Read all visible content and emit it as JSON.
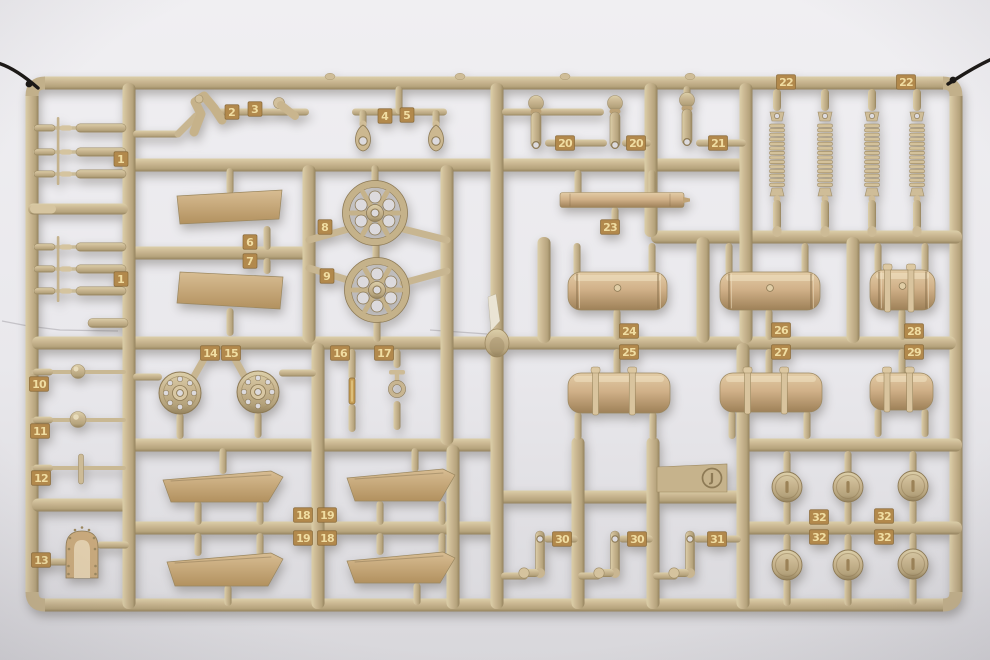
{
  "photo": {
    "subject": "tan plastic model-kit sprue (parts tree) photographed on a light gray background, hung on black wires",
    "sprue_letter": "J"
  },
  "sprue": {
    "letter": "J",
    "colors": {
      "runner_light": "#dccfa9",
      "runner_mid": "#c9b691",
      "runner_dark": "#94825d",
      "edge": "#8d7a55",
      "tag_bg": "#b2894c",
      "tag_text": "#f0dda2",
      "hole": "#dcdadd",
      "wire": "#1b1815",
      "bg_top": "#f0eff2",
      "bg_bottom": "#d8d7db"
    },
    "frame": {
      "top": 83,
      "bottom": 605,
      "left": 32,
      "right": 956,
      "thickness": 13
    },
    "runners_h": [
      [
        165,
        129,
        746
      ],
      [
        253,
        129,
        309
      ],
      [
        237,
        651,
        962
      ],
      [
        343,
        32,
        956
      ],
      [
        445,
        129,
        497
      ],
      [
        445,
        743,
        962
      ],
      [
        497,
        497,
        743
      ],
      [
        505,
        32,
        129
      ],
      [
        528,
        129,
        497
      ],
      [
        528,
        743,
        962
      ]
    ],
    "runners_v": [
      [
        129,
        83,
        609
      ],
      [
        309,
        165,
        343
      ],
      [
        318,
        343,
        609
      ],
      [
        447,
        165,
        445
      ],
      [
        453,
        445,
        609
      ],
      [
        497,
        83,
        609
      ],
      [
        544,
        237,
        343
      ],
      [
        651,
        83,
        237
      ],
      [
        746,
        83,
        343
      ],
      [
        703,
        237,
        343
      ],
      [
        853,
        237,
        343
      ],
      [
        743,
        343,
        609
      ],
      [
        578,
        437,
        609
      ],
      [
        653,
        437,
        609
      ]
    ],
    "rods_h": [
      [
        133,
        180,
        134
      ],
      [
        216,
        309,
        112
      ],
      [
        352,
        447,
        112
      ],
      [
        502,
        604,
        112
      ],
      [
        545,
        607,
        143
      ],
      [
        622,
        651,
        143
      ],
      [
        696,
        746,
        143
      ],
      [
        133,
        162,
        377
      ],
      [
        279,
        316,
        373
      ],
      [
        97,
        129,
        545
      ],
      [
        32,
        68,
        562
      ],
      [
        501,
        528,
        576
      ],
      [
        578,
        601,
        576
      ],
      [
        653,
        678,
        576
      ],
      [
        544,
        578,
        539
      ],
      [
        619,
        653,
        539
      ],
      [
        694,
        741,
        539
      ]
    ],
    "arms": [
      [
        309,
        240,
        352,
        228
      ],
      [
        399,
        228,
        447,
        240
      ],
      [
        309,
        268,
        351,
        281
      ],
      [
        403,
        283,
        447,
        271
      ],
      [
        192,
        380,
        208,
        352
      ],
      [
        246,
        379,
        231,
        352
      ],
      [
        178,
        134,
        196,
        116
      ]
    ],
    "stubs_v": [
      [
        399,
        86,
        112
      ],
      [
        363,
        110,
        126
      ],
      [
        436,
        110,
        126
      ],
      [
        230,
        168,
        192
      ],
      [
        267,
        226,
        248
      ],
      [
        267,
        258,
        272
      ],
      [
        230,
        308,
        334
      ],
      [
        375,
        165,
        186
      ],
      [
        376,
        240,
        263
      ],
      [
        377,
        317,
        340
      ],
      [
        687,
        86,
        97
      ],
      [
        578,
        170,
        194
      ],
      [
        652,
        170,
        194
      ],
      [
        615,
        207,
        221
      ],
      [
        577,
        243,
        273
      ],
      [
        652,
        243,
        273
      ],
      [
        617,
        309,
        338
      ],
      [
        617,
        349,
        374
      ],
      [
        578,
        412,
        438
      ],
      [
        653,
        412,
        438
      ],
      [
        729,
        243,
        273
      ],
      [
        805,
        243,
        273
      ],
      [
        769,
        309,
        338
      ],
      [
        769,
        349,
        374
      ],
      [
        732,
        411,
        437
      ],
      [
        807,
        411,
        437
      ],
      [
        878,
        243,
        271
      ],
      [
        925,
        243,
        271
      ],
      [
        902,
        309,
        338
      ],
      [
        902,
        349,
        374
      ],
      [
        878,
        409,
        435
      ],
      [
        925,
        409,
        435
      ],
      [
        180,
        413,
        437
      ],
      [
        258,
        412,
        436
      ],
      [
        352,
        349,
        378
      ],
      [
        352,
        404,
        430
      ],
      [
        397,
        349,
        366
      ],
      [
        397,
        401,
        428
      ],
      [
        223,
        448,
        472
      ],
      [
        415,
        448,
        470
      ],
      [
        198,
        501,
        523
      ],
      [
        260,
        501,
        523
      ],
      [
        380,
        501,
        523
      ],
      [
        442,
        501,
        523
      ],
      [
        198,
        533,
        554
      ],
      [
        260,
        533,
        554
      ],
      [
        380,
        533,
        553
      ],
      [
        442,
        533,
        553
      ],
      [
        228,
        585,
        604
      ],
      [
        417,
        583,
        603
      ],
      [
        787,
        451,
        474
      ],
      [
        848,
        451,
        474
      ],
      [
        913,
        451,
        473
      ],
      [
        787,
        500,
        523
      ],
      [
        848,
        500,
        523
      ],
      [
        913,
        499,
        522
      ],
      [
        787,
        534,
        552
      ],
      [
        848,
        534,
        552
      ],
      [
        913,
        533,
        551
      ],
      [
        787,
        578,
        604
      ],
      [
        848,
        578,
        604
      ],
      [
        913,
        577,
        603
      ]
    ],
    "bumps": [
      330,
      460,
      565,
      690
    ],
    "tags": [
      [
        "1",
        121,
        159
      ],
      [
        "1",
        121,
        279
      ],
      [
        "2",
        232,
        112
      ],
      [
        "3",
        255,
        109
      ],
      [
        "4",
        385,
        116
      ],
      [
        "5",
        407,
        115
      ],
      [
        "6",
        250,
        242
      ],
      [
        "7",
        250,
        261
      ],
      [
        "8",
        325,
        227
      ],
      [
        "9",
        327,
        276
      ],
      [
        "10",
        39,
        384
      ],
      [
        "11",
        40,
        431
      ],
      [
        "12",
        41,
        478
      ],
      [
        "13",
        41,
        560
      ],
      [
        "14",
        210,
        353
      ],
      [
        "15",
        231,
        353
      ],
      [
        "16",
        340,
        353
      ],
      [
        "17",
        384,
        353
      ],
      [
        "18",
        303,
        515
      ],
      [
        "19",
        327,
        515
      ],
      [
        "19",
        303,
        538
      ],
      [
        "18",
        327,
        538
      ],
      [
        "20",
        565,
        143
      ],
      [
        "20",
        636,
        143
      ],
      [
        "21",
        718,
        143
      ],
      [
        "22",
        786,
        82
      ],
      [
        "22",
        906,
        82
      ],
      [
        "23",
        610,
        227
      ],
      [
        "24",
        629,
        331
      ],
      [
        "25",
        629,
        352
      ],
      [
        "26",
        781,
        330
      ],
      [
        "27",
        781,
        352
      ],
      [
        "28",
        914,
        331
      ],
      [
        "29",
        914,
        352
      ],
      [
        "30",
        562,
        539
      ],
      [
        "30",
        637,
        539
      ],
      [
        "31",
        717,
        539
      ],
      [
        "32",
        819,
        517
      ],
      [
        "32",
        884,
        516
      ],
      [
        "32",
        819,
        537
      ],
      [
        "32",
        884,
        537
      ]
    ],
    "parts": [
      {
        "type": "rodgroup",
        "name": "part-1-torsion-bars-upper",
        "rows": [
          128,
          152,
          174
        ]
      },
      {
        "type": "rodgroup",
        "name": "part-1-torsion-bars-lower",
        "rows": [
          247,
          269,
          291
        ]
      },
      {
        "type": "thickrod",
        "name": "left-rung-rod",
        "x1": 28,
        "x2": 128,
        "y": 209
      },
      {
        "type": "bulletrod",
        "name": "left-small-rod",
        "x1": 88,
        "x2": 128,
        "y": 323
      },
      {
        "type": "bracket",
        "name": "part-2-bracket-arm",
        "x": 206,
        "y": 112
      },
      {
        "type": "padarm",
        "name": "part-3-pad-arm",
        "x": 282,
        "y": 106
      },
      {
        "type": "towhook",
        "name": "part-4-tow-shackle",
        "x": 363
      },
      {
        "type": "towhook",
        "name": "part-5-tow-shackle",
        "x": 436
      },
      {
        "type": "panel",
        "name": "part-6-panel",
        "x": 177,
        "y": 190,
        "w": 105,
        "h": 34,
        "skew": 1
      },
      {
        "type": "panel",
        "name": "part-7-panel",
        "x": 177,
        "y": 272,
        "w": 106,
        "h": 37,
        "skew": -1
      },
      {
        "type": "spokewheel",
        "name": "part-8-spoked-wheel",
        "x": 375,
        "y": 213
      },
      {
        "type": "spokewheel",
        "name": "part-9-spoked-wheel",
        "x": 377,
        "y": 290
      },
      {
        "type": "ballrod",
        "name": "part-10-ball-rod",
        "y": 372,
        "r": 7
      },
      {
        "type": "ballrod",
        "name": "part-11-ball-rod",
        "y": 420,
        "r": 8
      },
      {
        "type": "pinrod",
        "name": "part-12-pin-rod",
        "y": 468
      },
      {
        "type": "dome",
        "name": "part-13-armored-dome",
        "x": 82,
        "y": 554
      },
      {
        "type": "hubwheel",
        "name": "part-14-hub-wheel",
        "x": 180,
        "y": 393
      },
      {
        "type": "hubwheel",
        "name": "part-15-hub-wheel",
        "x": 258,
        "y": 392
      },
      {
        "type": "clip",
        "name": "part-16-clip",
        "x": 352,
        "y": 391
      },
      {
        "type": "shackle",
        "name": "part-17-shackle-pin",
        "x": 397,
        "y": 379
      },
      {
        "type": "fender",
        "name": "part-18-fender",
        "x": 163,
        "y": 471,
        "w": 120,
        "h": 31
      },
      {
        "type": "fender",
        "name": "part-19-fender",
        "x": 347,
        "y": 469,
        "w": 108,
        "h": 32
      },
      {
        "type": "fender",
        "name": "part-19-fender-b",
        "x": 167,
        "y": 553,
        "w": 116,
        "h": 33
      },
      {
        "type": "fender",
        "name": "part-18-fender-b",
        "x": 347,
        "y": 552,
        "w": 108,
        "h": 31
      },
      {
        "type": "lever",
        "name": "part-20-lever-a",
        "x": 536,
        "y": 100
      },
      {
        "type": "lever",
        "name": "part-20-lever-b",
        "x": 615,
        "y": 100
      },
      {
        "type": "lever",
        "name": "part-21-lever",
        "x": 687,
        "y": 97
      },
      {
        "type": "spring",
        "name": "part-22-spring-a",
        "x": 777
      },
      {
        "type": "spring",
        "name": "part-22-spring-b",
        "x": 825
      },
      {
        "type": "spring",
        "name": "part-22-spring-c",
        "x": 872
      },
      {
        "type": "spring",
        "name": "part-22-spring-d",
        "x": 917
      },
      {
        "type": "bar",
        "name": "part-23-bar",
        "x1": 560,
        "x2": 690,
        "y": 200
      },
      {
        "type": "tank",
        "name": "part-24-fuel-tank",
        "x": 568,
        "y": 272,
        "w": 99,
        "h": 38,
        "style": "rings"
      },
      {
        "type": "tank",
        "name": "part-25-fuel-tank",
        "x": 568,
        "y": 373,
        "w": 102,
        "h": 40,
        "style": "straps"
      },
      {
        "type": "tank",
        "name": "part-26-fuel-tank",
        "x": 720,
        "y": 272,
        "w": 100,
        "h": 38,
        "style": "rings"
      },
      {
        "type": "tank",
        "name": "part-27-fuel-tank",
        "x": 720,
        "y": 373,
        "w": 102,
        "h": 39,
        "style": "straps"
      },
      {
        "type": "tank",
        "name": "part-28-fuel-tank",
        "x": 870,
        "y": 270,
        "w": 65,
        "h": 40,
        "style": "both"
      },
      {
        "type": "tank",
        "name": "part-29-fuel-tank",
        "x": 870,
        "y": 373,
        "w": 63,
        "h": 37,
        "style": "straps"
      },
      {
        "type": "crank",
        "name": "part-30-crank-a",
        "x": 540
      },
      {
        "type": "crank",
        "name": "part-30-crank-b",
        "x": 615
      },
      {
        "type": "crank",
        "name": "part-31-crank",
        "x": 690
      },
      {
        "type": "disc",
        "name": "part-32-disc-a",
        "x": 787,
        "y": 487
      },
      {
        "type": "disc",
        "name": "part-32-disc-b",
        "x": 848,
        "y": 487
      },
      {
        "type": "disc",
        "name": "part-32-disc-c",
        "x": 913,
        "y": 486
      },
      {
        "type": "disc",
        "name": "part-32-disc-d",
        "x": 787,
        "y": 565
      },
      {
        "type": "disc",
        "name": "part-32-disc-e",
        "x": 848,
        "y": 565
      },
      {
        "type": "disc",
        "name": "part-32-disc-f",
        "x": 913,
        "y": 564
      },
      {
        "type": "plate",
        "name": "sprue-letter-plate",
        "x": 657,
        "y": 464,
        "w": 70,
        "h": 28
      },
      {
        "type": "gate",
        "name": "injection-gate",
        "x": 497,
        "y": 343
      }
    ],
    "wires": [
      {
        "d": "M -2,63 C 8,66 22,74 38,88",
        "wrap": [
          29,
          84
        ]
      },
      {
        "d": "M 948,84 C 958,78 972,68 992,59",
        "wrap": [
          953,
          80
        ]
      }
    ],
    "marks": [
      {
        "points": "2,321 28,326 60,330 118,331"
      },
      {
        "points": "430,330 487,334"
      }
    ]
  }
}
